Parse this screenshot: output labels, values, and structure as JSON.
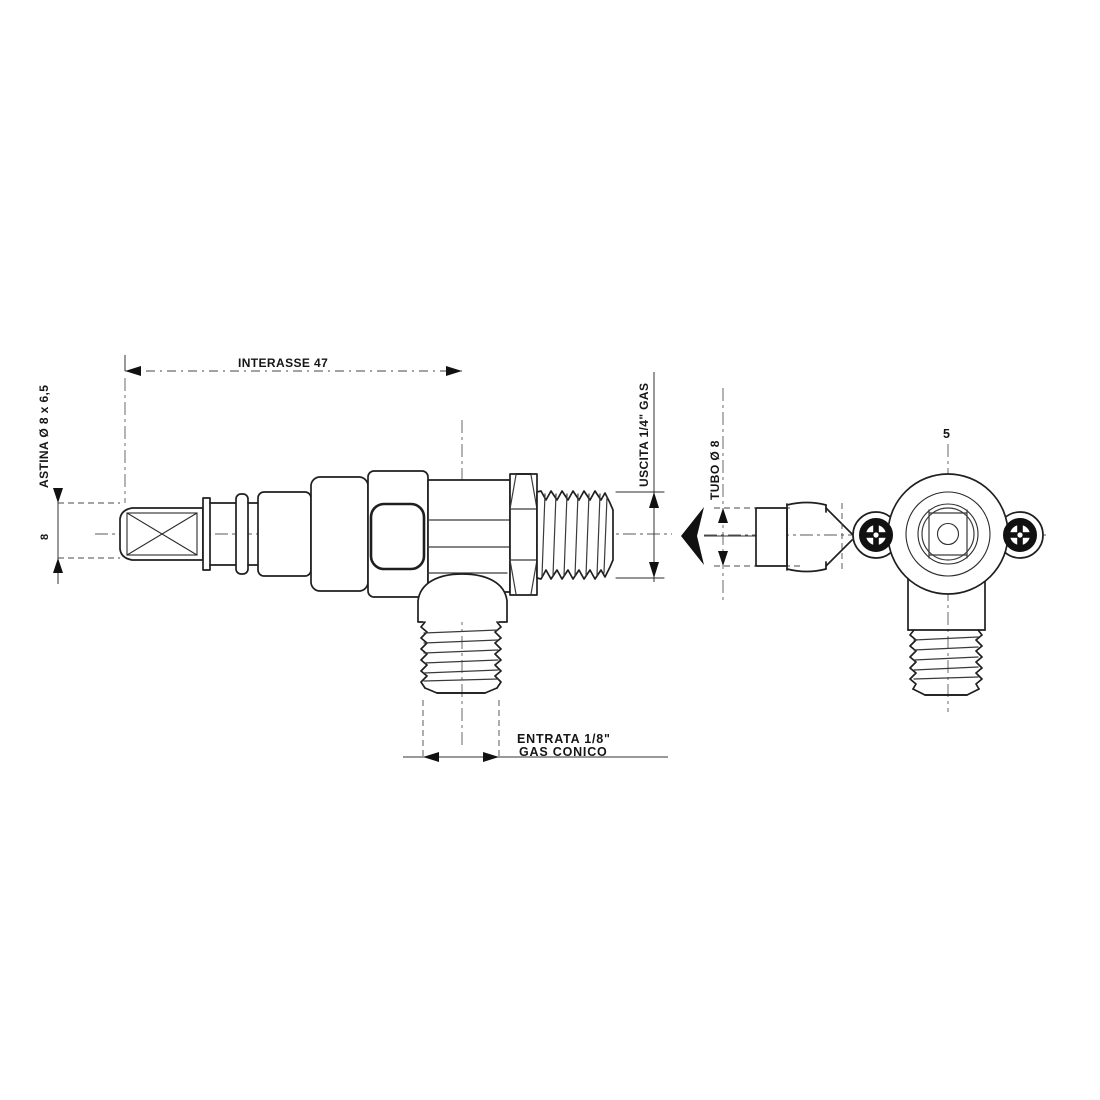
{
  "drawing": {
    "part_number": "5",
    "labels": {
      "interasse": "INTERASSE 47",
      "astina": "ASTINA Ø 8 x 6,5",
      "rod_diameter": "8",
      "uscita": "USCITA 1/4\" GAS",
      "tubo": "TUBO Ø 8",
      "entrata_line1": "ENTRATA 1/8\"",
      "entrata_line2": "GAS CONICO"
    },
    "colors": {
      "line": "#1f1f1f",
      "background": "#ffffff"
    }
  }
}
